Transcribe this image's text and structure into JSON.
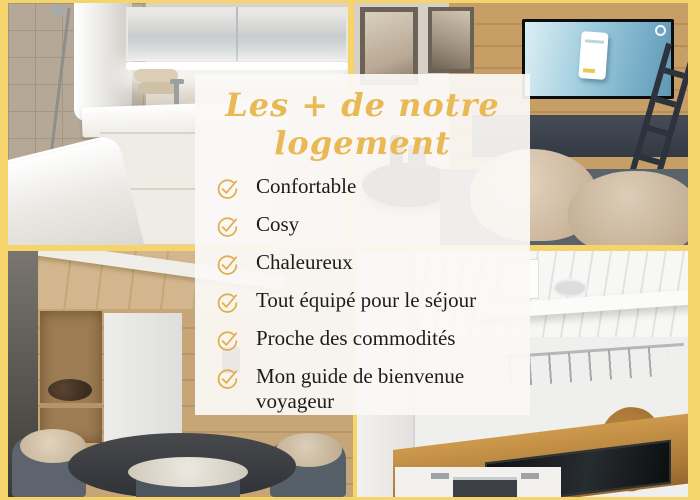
{
  "collage": {
    "title": {
      "line1": "Les + de notre",
      "line2": "logement"
    },
    "features": [
      "Confortable",
      "Cosy",
      "Chaleureux",
      "Tout équipé pour le séjour",
      "Proche des commodités",
      "Mon guide de bienvenue voyageur"
    ],
    "icons": {
      "feature_bullet": "check-circle-icon"
    },
    "photos": [
      {
        "id": "bathroom",
        "label": "bathroom with bathtub, sink and lit mirror cabinet"
      },
      {
        "id": "living-room",
        "label": "living room with TV on wood wall, ladder and fur-covered sofa"
      },
      {
        "id": "dining-area",
        "label": "wood-panelled dining corner with round table and fur-draped chairs"
      },
      {
        "id": "kitchen",
        "label": "kitchen with wood worktop, induction hob and open shelf"
      }
    ],
    "colors": {
      "frame-yellow": "#f5d46c",
      "title-gold": "#e9b955",
      "check-gold": "#dfae4a",
      "text-dark": "#1d1c1a"
    }
  }
}
